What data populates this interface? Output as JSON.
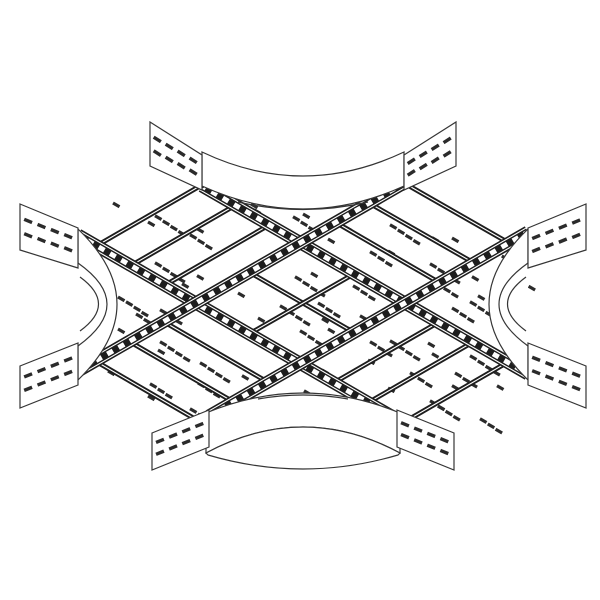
{
  "meta": {
    "subject": "4-way cable ladder cross fitting, isometric technical line drawing"
  },
  "colors": {
    "background": "#ffffff",
    "line": "#353535",
    "band": "#1d1d1d",
    "slot": "#2b2b2b",
    "white": "#ffffff"
  },
  "drawing": {
    "width": 600,
    "height": 600,
    "rails": [
      {
        "name": "rail-nw-se-upper",
        "seg": [
          202,
          186,
          528,
          374
        ]
      },
      {
        "name": "rail-nw-se-lower",
        "seg": [
          78,
          235,
          400,
          421
        ]
      },
      {
        "name": "rail-ne-sw-upper",
        "seg": [
          404,
          183,
          78,
          371
        ]
      },
      {
        "name": "rail-ne-sw-lower",
        "seg": [
          528,
          232,
          209,
          416
        ]
      }
    ],
    "rung_bands": [
      {
        "name": "band-nw-end",
        "seg": [
          200,
          186,
          98,
          245
        ]
      },
      {
        "name": "band-nw-1",
        "seg": [
          234,
          206,
          132,
          265
        ]
      },
      {
        "name": "band-nw-2",
        "seg": [
          269,
          225,
          167,
          284
        ]
      },
      {
        "name": "band-se-end",
        "seg": [
          406,
          421,
          508,
          362
        ]
      },
      {
        "name": "band-se-1",
        "seg": [
          371,
          401,
          473,
          342
        ]
      },
      {
        "name": "band-se-2",
        "seg": [
          337,
          381,
          439,
          322
        ]
      },
      {
        "name": "band-ne-end",
        "seg": [
          404,
          183,
          509,
          243
        ]
      },
      {
        "name": "band-ne-1",
        "seg": [
          369,
          203,
          474,
          263
        ]
      },
      {
        "name": "band-ne-2",
        "seg": [
          335,
          222,
          440,
          283
        ]
      },
      {
        "name": "band-sw-end",
        "seg": [
          202,
          423,
          97,
          362
        ]
      },
      {
        "name": "band-sw-1",
        "seg": [
          237,
          404,
          132,
          343
        ]
      },
      {
        "name": "band-sw-2",
        "seg": [
          271,
          384,
          166,
          323
        ]
      },
      {
        "name": "band-center-a",
        "seg": [
          249,
          272,
          353,
          332
        ]
      },
      {
        "name": "band-center-b",
        "seg": [
          249,
          334,
          352,
          275
        ]
      }
    ],
    "fans": [
      {
        "name": "fan-top",
        "faces": [
          {
            "d": "M202,152 Q303,200 404,152 L404,186 Q303,232 202,186 Z",
            "outlined": true
          }
        ],
        "strokes": [
          "M238,202 Q303,217 368,202"
        ]
      },
      {
        "name": "fan-bottom",
        "faces": [
          {
            "d": "M206,413 Q303,373 400,413 L400,453 Q303,401 206,453 Z",
            "outlined": true
          },
          {
            "d": "M206,453 Q303,401 400,453 L398,455 Q303,483 208,455 Z",
            "outlined": true
          }
        ],
        "strokes": [
          "M258,399 Q303,391 348,399"
        ]
      },
      {
        "name": "fan-left",
        "faces": [
          {
            "d": "M78,229 Q156,304 78,380 Z",
            "outlined": false
          }
        ],
        "strokes": [
          "M78,229 Q156,304 78,380",
          "M78,263 Q136,304 78,346",
          "M80,277 Q117,304 80,331",
          "M78,229 L78,263",
          "M78,346 L78,380"
        ]
      },
      {
        "name": "fan-right",
        "faces": [
          {
            "d": "M528,229 Q450,304 528,380 Z",
            "outlined": false
          }
        ],
        "strokes": [
          "M528,229 Q450,304 528,380",
          "M528,263 Q470,304 528,346",
          "M526,277 Q489,304 526,331",
          "M528,229 L528,263",
          "M528,346 L528,380"
        ]
      }
    ],
    "flanges": [
      {
        "name": "flange-top-left",
        "points": [
          [
            150,
            122
          ],
          [
            202,
            155
          ],
          [
            202,
            190
          ],
          [
            150,
            166
          ]
        ]
      },
      {
        "name": "flange-top-right",
        "points": [
          [
            404,
            155
          ],
          [
            456,
            122
          ],
          [
            456,
            166
          ],
          [
            404,
            190
          ]
        ]
      },
      {
        "name": "flange-left-top",
        "points": [
          [
            20,
            204
          ],
          [
            78,
            228
          ],
          [
            78,
            268
          ],
          [
            20,
            250
          ]
        ]
      },
      {
        "name": "flange-right-top",
        "points": [
          [
            528,
            228
          ],
          [
            586,
            204
          ],
          [
            586,
            250
          ],
          [
            528,
            268
          ]
        ]
      },
      {
        "name": "flange-left-bottom",
        "points": [
          [
            20,
            366
          ],
          [
            78,
            343
          ],
          [
            78,
            385
          ],
          [
            20,
            408
          ]
        ]
      },
      {
        "name": "flange-right-bottom",
        "points": [
          [
            528,
            343
          ],
          [
            586,
            366
          ],
          [
            586,
            408
          ],
          [
            528,
            385
          ]
        ]
      },
      {
        "name": "flange-bottom-left",
        "points": [
          [
            152,
            433
          ],
          [
            209,
            410
          ],
          [
            209,
            447
          ],
          [
            152,
            470
          ]
        ]
      },
      {
        "name": "flange-bottom-right",
        "points": [
          [
            397,
            410
          ],
          [
            454,
            433
          ],
          [
            454,
            470
          ],
          [
            397,
            447
          ]
        ]
      }
    ],
    "flange_slot_grid": {
      "u": [
        0.14,
        0.37,
        0.6,
        0.83
      ],
      "v": [
        0.3,
        0.62
      ],
      "dash_len": 8.5,
      "dash_width": 3.4
    },
    "slot_geometry": {
      "dash_dx": 6.5,
      "dash_dy": 3.75,
      "dash_width": 3.2,
      "step_dx": 7.8,
      "step_dy": 5.2,
      "group_dx": 42,
      "group_dy": 12.8
    },
    "slot_rows": [
      {
        "x": 212,
        "y": 197,
        "g": [
          1,
          4
        ]
      },
      {
        "x": 113,
        "y": 203,
        "g": [
          1,
          4,
          1
        ]
      },
      {
        "x": 148,
        "y": 222,
        "g": [
          1,
          3
        ]
      },
      {
        "x": 113,
        "y": 250,
        "g": [
          1,
          4,
          1
        ]
      },
      {
        "x": 140,
        "y": 271,
        "g": [
          3,
          1
        ]
      },
      {
        "x": 84,
        "y": 289,
        "g": [
          1,
          3
        ]
      },
      {
        "x": 251,
        "y": 204,
        "g": [
          1,
          4
        ]
      },
      {
        "x": 303,
        "y": 214,
        "g": [
          1,
          3
        ]
      },
      {
        "x": 348,
        "y": 212,
        "g": [
          1,
          4,
          1
        ]
      },
      {
        "x": 452,
        "y": 238,
        "g": [
          1,
          4
        ]
      },
      {
        "x": 328,
        "y": 239,
        "g": [
          1,
          3
        ]
      },
      {
        "x": 388,
        "y": 251,
        "g": [
          1,
          4,
          1
        ]
      },
      {
        "x": 471,
        "y": 263,
        "g": [
          1,
          3
        ]
      },
      {
        "x": 436,
        "y": 283,
        "g": [
          3,
          1
        ]
      },
      {
        "x": 118,
        "y": 297,
        "g": [
          1,
          3
        ]
      },
      {
        "x": 136,
        "y": 314,
        "g": [
          3
        ]
      },
      {
        "x": 253,
        "y": 264,
        "g": [
          1,
          4
        ]
      },
      {
        "x": 311,
        "y": 273,
        "g": [
          1,
          3
        ]
      },
      {
        "x": 238,
        "y": 293,
        "g": [
          1,
          4,
          1
        ]
      },
      {
        "x": 318,
        "y": 303,
        "g": [
          3,
          1
        ]
      },
      {
        "x": 258,
        "y": 318,
        "g": [
          1,
          4
        ]
      },
      {
        "x": 328,
        "y": 329,
        "g": [
          1,
          3
        ]
      },
      {
        "x": 428,
        "y": 289,
        "g": [
          1,
          3
        ]
      },
      {
        "x": 452,
        "y": 308,
        "g": [
          3
        ]
      },
      {
        "x": 118,
        "y": 329,
        "g": [
          1,
          4
        ]
      },
      {
        "x": 158,
        "y": 350,
        "g": [
          1,
          4,
          1
        ]
      },
      {
        "x": 108,
        "y": 371,
        "g": [
          1,
          3
        ]
      },
      {
        "x": 198,
        "y": 383,
        "g": [
          3,
          1
        ]
      },
      {
        "x": 148,
        "y": 396,
        "g": [
          1,
          4
        ]
      },
      {
        "x": 226,
        "y": 406,
        "g": [
          1,
          3
        ]
      },
      {
        "x": 348,
        "y": 328,
        "g": [
          1,
          4,
          1
        ]
      },
      {
        "x": 428,
        "y": 343,
        "g": [
          1,
          4
        ]
      },
      {
        "x": 368,
        "y": 360,
        "g": [
          1,
          3,
          1
        ]
      },
      {
        "x": 455,
        "y": 373,
        "g": [
          3,
          1
        ]
      },
      {
        "x": 388,
        "y": 388,
        "g": [
          1,
          4
        ]
      },
      {
        "x": 438,
        "y": 406,
        "g": [
          1,
          3
        ]
      },
      {
        "x": 262,
        "y": 378,
        "g": [
          1,
          3
        ]
      },
      {
        "x": 322,
        "y": 370,
        "g": [
          3
        ]
      }
    ],
    "bolts": [
      [
        202,
        186
      ],
      [
        404,
        183
      ],
      [
        78,
        235
      ],
      [
        528,
        232
      ],
      [
        78,
        371
      ],
      [
        528,
        374
      ],
      [
        209,
        416
      ],
      [
        400,
        421
      ]
    ]
  }
}
